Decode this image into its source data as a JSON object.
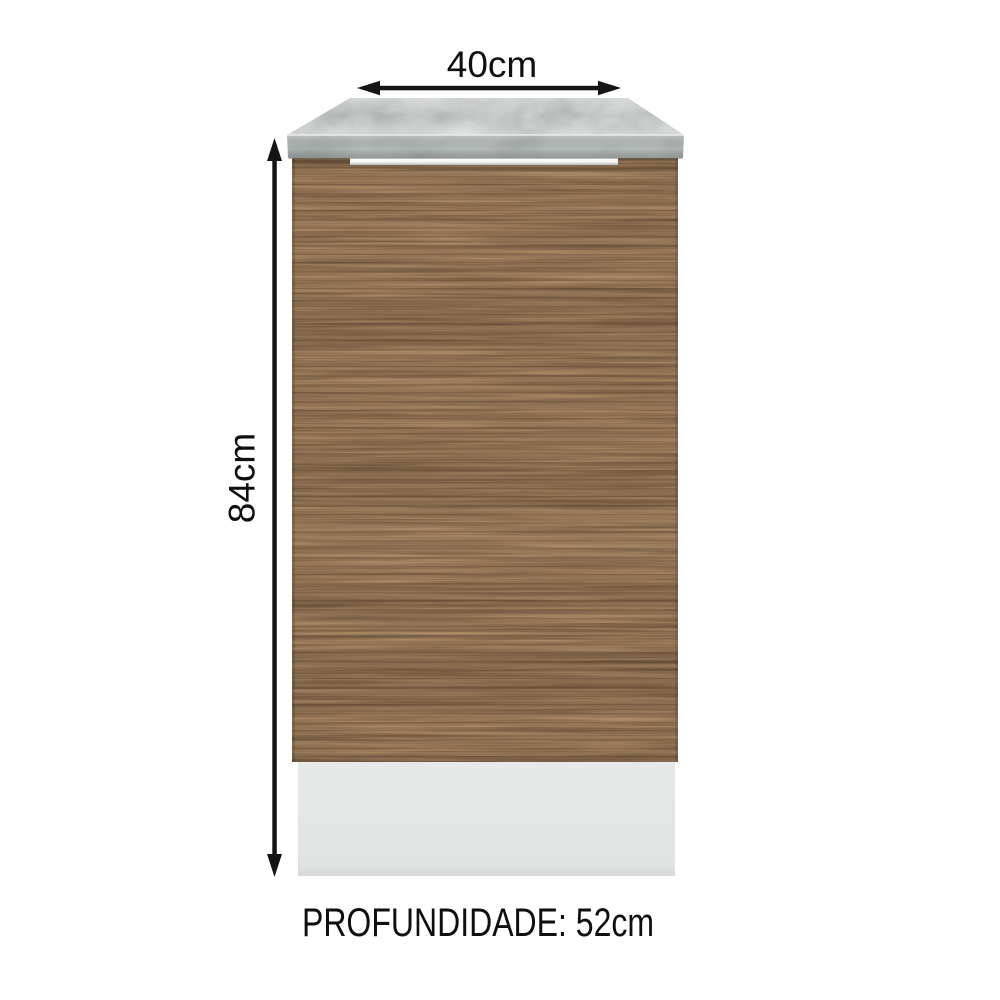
{
  "labels": {
    "width": "40cm",
    "height": "84cm",
    "depth": "PROFUNDIDADE: 52cm"
  },
  "colors": {
    "background": "#ffffff",
    "text": "#0f0f0f",
    "arrow": "#141414",
    "countertop_top": "#c6cac8",
    "countertop_front": "#b4bab8",
    "countertop_edge_highlight": "#e9ebea",
    "gap_shadow": "#75756e",
    "handle_strip_light": "#ffffff",
    "handle_strip_dark": "#b5b8b7",
    "door_wood_base": "#957557",
    "door_wood_dark": "#5c452f",
    "door_wood_light": "#c7a378",
    "plinth_light": "#e7e9e9",
    "plinth_dark": "#dddfdf"
  }
}
